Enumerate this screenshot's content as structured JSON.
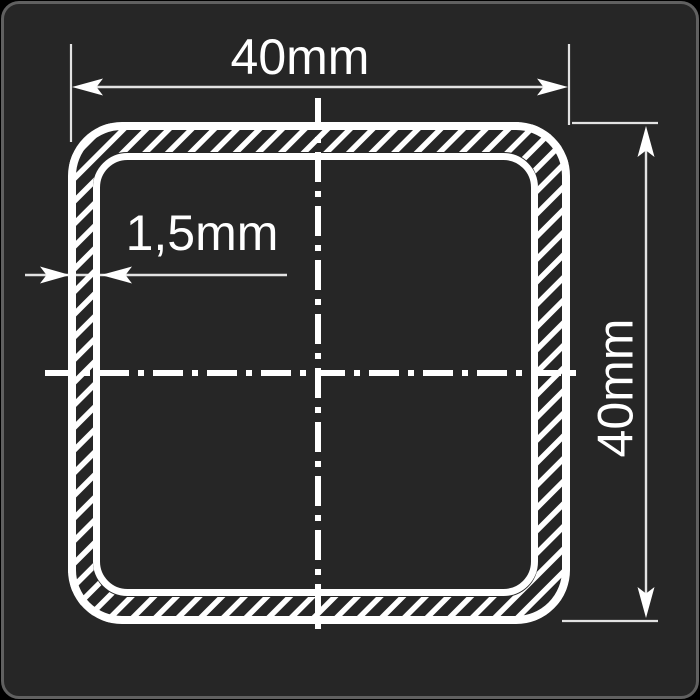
{
  "drawing": {
    "type": "technical-cross-section",
    "subject": "square hollow tube profile",
    "dimensions": {
      "width_label": "40mm",
      "height_label": "40mm",
      "wall_thickness_label": "1,5mm"
    },
    "colors": {
      "panel_background": "#262626",
      "panel_border": "#606060",
      "outside_background": "#000000",
      "contour_line": "#ffffff",
      "dimension_line": "#e2e2e2",
      "label_text": "#ffffff"
    }
  }
}
